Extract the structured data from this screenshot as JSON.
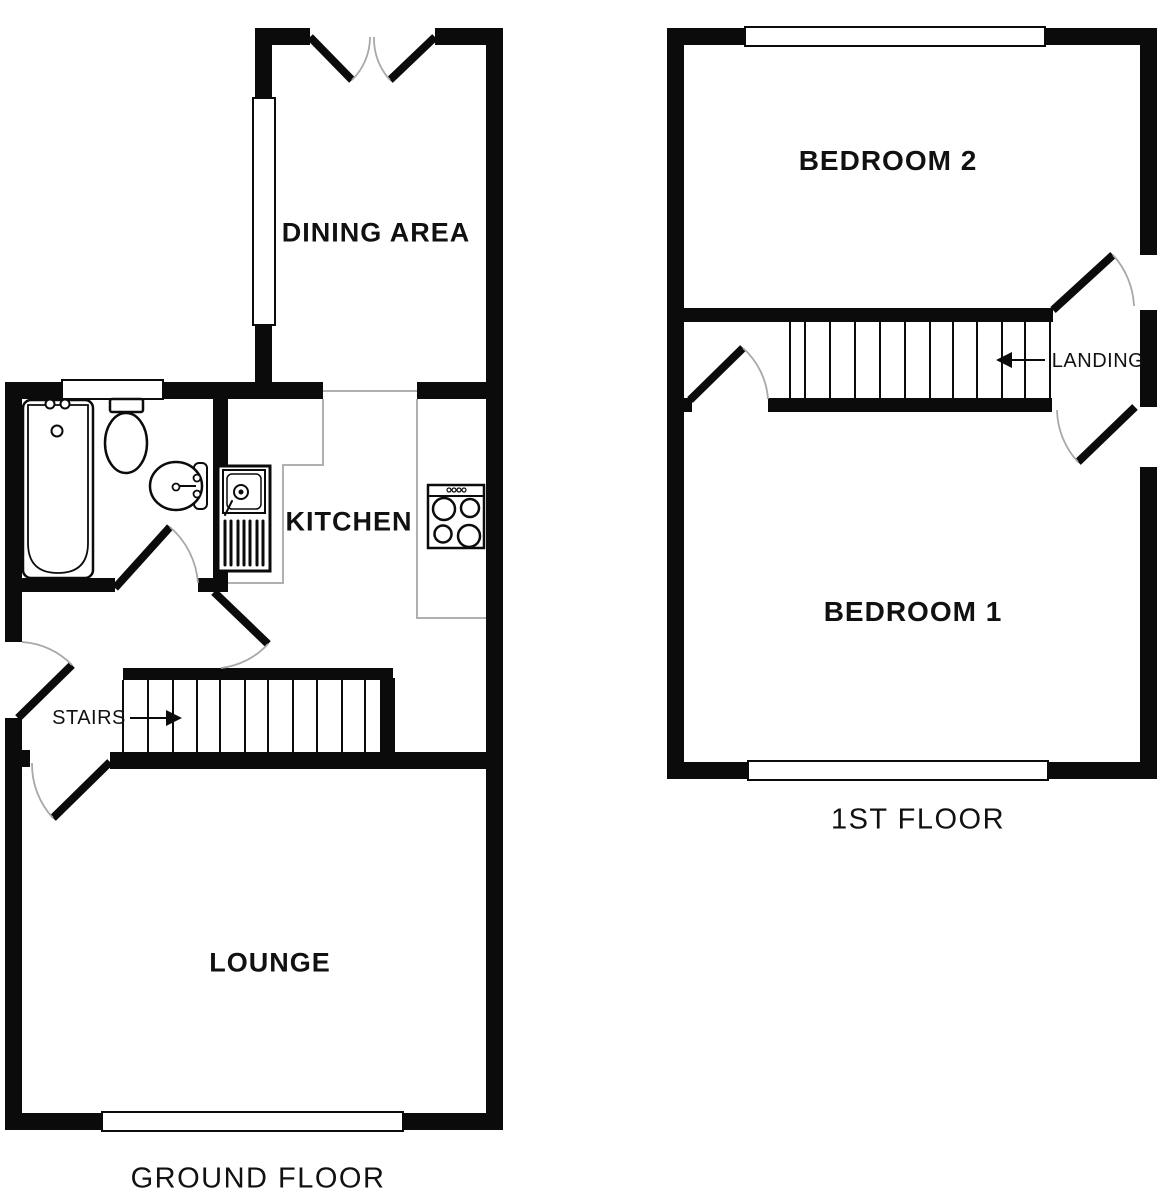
{
  "diagram_type": "floorplan",
  "colors": {
    "wall": "#0b0b0b",
    "thin": "#b0b0b0",
    "arc": "#a8a8a8",
    "bg": "#ffffff",
    "text": "#111111"
  },
  "ground_floor": {
    "title": "GROUND FLOOR",
    "rooms": {
      "dining": "DINING AREA",
      "kitchen": "KITCHEN",
      "lounge": "LOUNGE"
    },
    "stairs_label": "STAIRS",
    "fixtures": [
      "bathtub",
      "toilet",
      "wash-basin",
      "kitchen-sink",
      "cooker-hob"
    ],
    "features": [
      "french-doors",
      "front-door",
      "bathroom-door",
      "kitchen-door",
      "lounge-door",
      "staircase-up",
      "windows"
    ]
  },
  "first_floor": {
    "title": "1ST FLOOR",
    "rooms": {
      "bedroom2": "BEDROOM 2",
      "bedroom1": "BEDROOM 1"
    },
    "landing_label": "LANDING",
    "features": [
      "bedroom2-door",
      "bedroom1-door",
      "landing-door",
      "staircase-down",
      "windows"
    ]
  }
}
